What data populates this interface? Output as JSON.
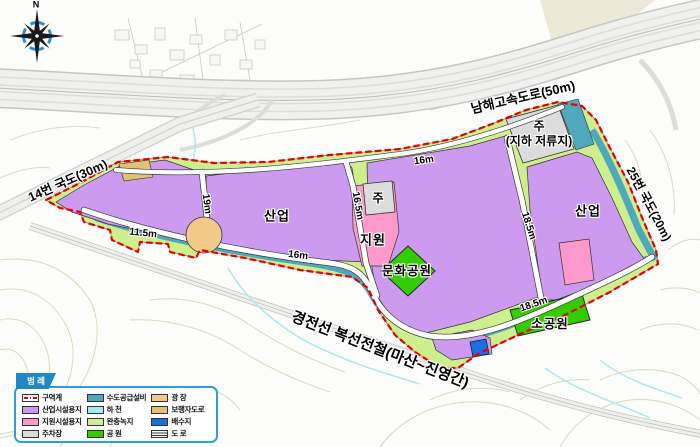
{
  "map": {
    "compass_label": "N",
    "roads": {
      "expressway": "남해고속도로(50m)",
      "route14": "14번 국도(30m)",
      "route25": "25번 국도(20m)",
      "railway": "경전선 복선전철(마산~진영간)"
    },
    "parcels": {
      "industry_west": "산업",
      "industry_east": "산업",
      "support": "지원",
      "parking_small": "주",
      "parking_retention": "주",
      "retention_sub": "(지하 저류지)",
      "culture_park": "문화공원",
      "small_park": "소공원"
    },
    "widths": {
      "w11_5": "11.5m",
      "w19": "19m",
      "w16_top": "16m",
      "w16_bottom": "16m",
      "w16_5": "16.5m",
      "w18_5_road": "18.5m",
      "w18_5_south": "18.5m"
    }
  },
  "legend": {
    "title": "범 례",
    "columns": [
      {
        "items": [
          {
            "label": "구역계",
            "swatch": "boundary"
          },
          {
            "label": "산업시설용지",
            "swatch": "industrial"
          },
          {
            "label": "지원시설용지",
            "swatch": "support"
          },
          {
            "label": "주차장",
            "swatch": "parking"
          }
        ]
      },
      {
        "items": [
          {
            "label": "수도공급설비",
            "swatch": "water_supply"
          },
          {
            "label": "하 천",
            "swatch": "river"
          },
          {
            "label": "완충녹지",
            "swatch": "buffer_green"
          },
          {
            "label": "공 원",
            "swatch": "park"
          }
        ]
      },
      {
        "items": [
          {
            "label": "광 장",
            "swatch": "plaza"
          },
          {
            "label": "보행자도로",
            "swatch": "pedestrian"
          },
          {
            "label": "배수지",
            "swatch": "reservoir"
          },
          {
            "label": "도 로",
            "swatch": "road"
          }
        ]
      }
    ]
  },
  "palette": {
    "boundary": "#E60000",
    "industrial": "#CC9BF0",
    "support": "#FF99CC",
    "parking": "#DCDCDC",
    "water_supply": "#4FA8BC",
    "river": "#A8E8F0",
    "buffer_green": "#CDEF8E",
    "park": "#33CC00",
    "plaza": "#F3C988",
    "pedestrian": "#E0C272",
    "reservoir": "#1A6FE0"
  }
}
